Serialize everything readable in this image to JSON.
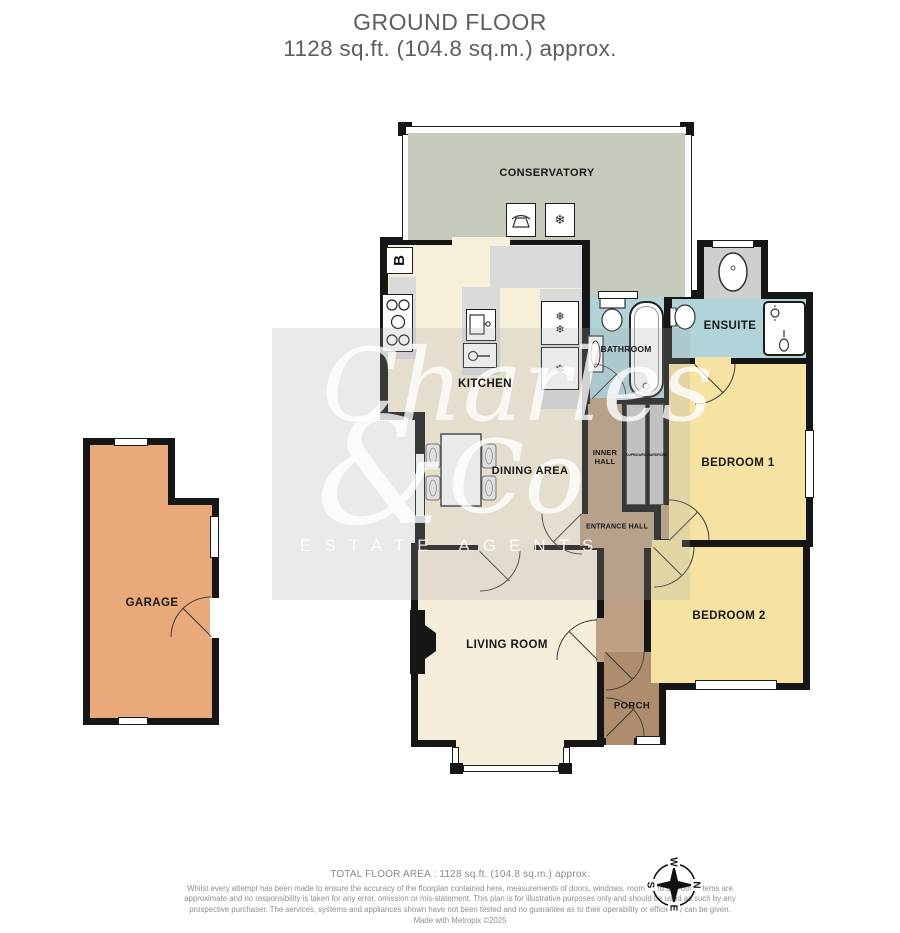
{
  "title": {
    "line1": "GROUND FLOOR",
    "line2": "1128 sq.ft. (104.8 sq.m.) approx."
  },
  "rooms": {
    "conservatory": {
      "label": "CONSERVATORY"
    },
    "kitchen": {
      "label": "KITCHEN"
    },
    "dining_area": {
      "label": "DINING AREA"
    },
    "bathroom": {
      "label": "BATHROOM"
    },
    "ensuite": {
      "label": "ENSUITE"
    },
    "inner_hall": {
      "label": "INNER HALL"
    },
    "entrance_hall": {
      "label": "ENTRANCE HALL"
    },
    "bedroom1": {
      "label": "BEDROOM 1"
    },
    "bedroom2": {
      "label": "BEDROOM 2"
    },
    "living_room": {
      "label": "LIVING ROOM"
    },
    "porch": {
      "label": "PORCH"
    },
    "garage": {
      "label": "GARAGE"
    },
    "cupboard": {
      "label": "CUPBOARD"
    },
    "wardrobe": {
      "label": "WARDROBE"
    }
  },
  "symbols": {
    "boiler": "B",
    "snowflake": "❄"
  },
  "compass": {
    "north": "N",
    "east": "E",
    "south": "S",
    "west": "W"
  },
  "watermark": {
    "word1": "Charles",
    "ampersand": "&",
    "word2": "Co",
    "subtitle": "ESTATE AGENTS"
  },
  "footer": {
    "total_area": "TOTAL FLOOR AREA : 1128 sq.ft. (104.8 sq.m.) approx.",
    "disclaimer": "Whilst every attempt has been made to ensure the accuracy of the floorplan contained here, measurements of doors, windows, rooms and any other items are approximate and no responsibility is taken for any error, omission or mis-statement. This plan is for illustrative purposes only and should be used as such by any prospective purchaser. The services, systems and appliances shown have not been tested and no guarantee as to their operability or efficiency can be given.",
    "credit": "Made with Metropix ©2025"
  },
  "colors": {
    "wall": "#161616",
    "conservatory": "#c4cabc",
    "kitchen_dining": "#f6efd9",
    "bedroom": "#f6e2a2",
    "bathroom": "#b1d4da",
    "hall": "#bda083",
    "porch": "#ad8d6d",
    "living": "#f3edda",
    "garage": "#e9a97a",
    "counter": "#dadada",
    "closet": "#c9c9c9"
  }
}
